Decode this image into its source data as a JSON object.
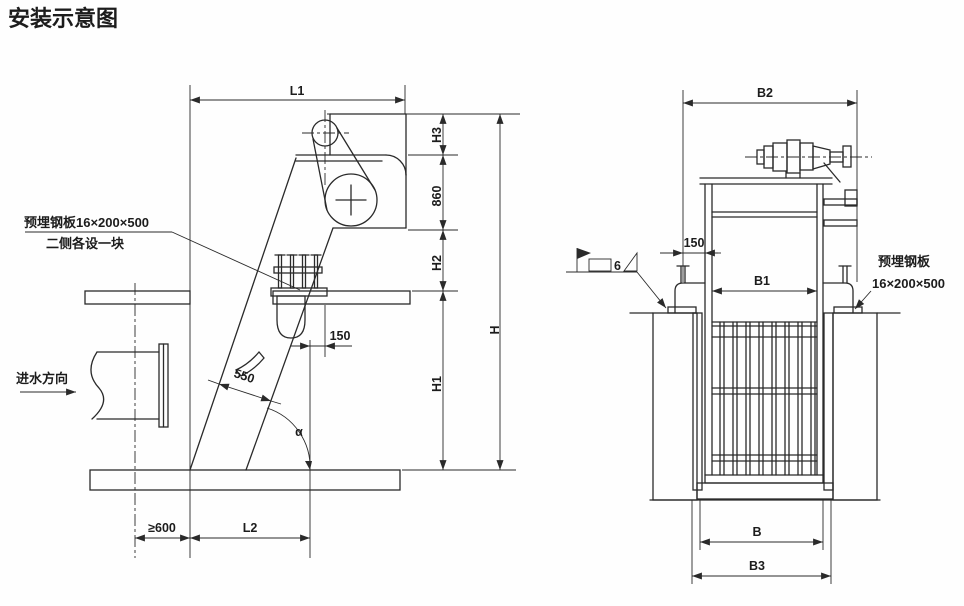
{
  "title": "安装示意图",
  "colors": {
    "title": "#1b58ab",
    "line": "#2a2a2a"
  },
  "left": {
    "dims": {
      "l1": "L1",
      "h3": "H3",
      "v860": "860",
      "h2": "H2",
      "h": "H",
      "h1": "H1",
      "v150": "150",
      "v550": "550",
      "alpha": "α",
      "ge600": "≥600",
      "l2": "L2"
    },
    "notes": {
      "plate1": "预埋钢板16×200×500",
      "plate2": "二侧各设一块",
      "flow": "进水方向"
    }
  },
  "right": {
    "dims": {
      "b2": "B2",
      "v150": "150",
      "b1": "B1",
      "b": "B",
      "b3": "B3"
    },
    "notes": {
      "plate1": "预埋钢板",
      "plate2": "16×200×500",
      "weld": "6"
    }
  }
}
